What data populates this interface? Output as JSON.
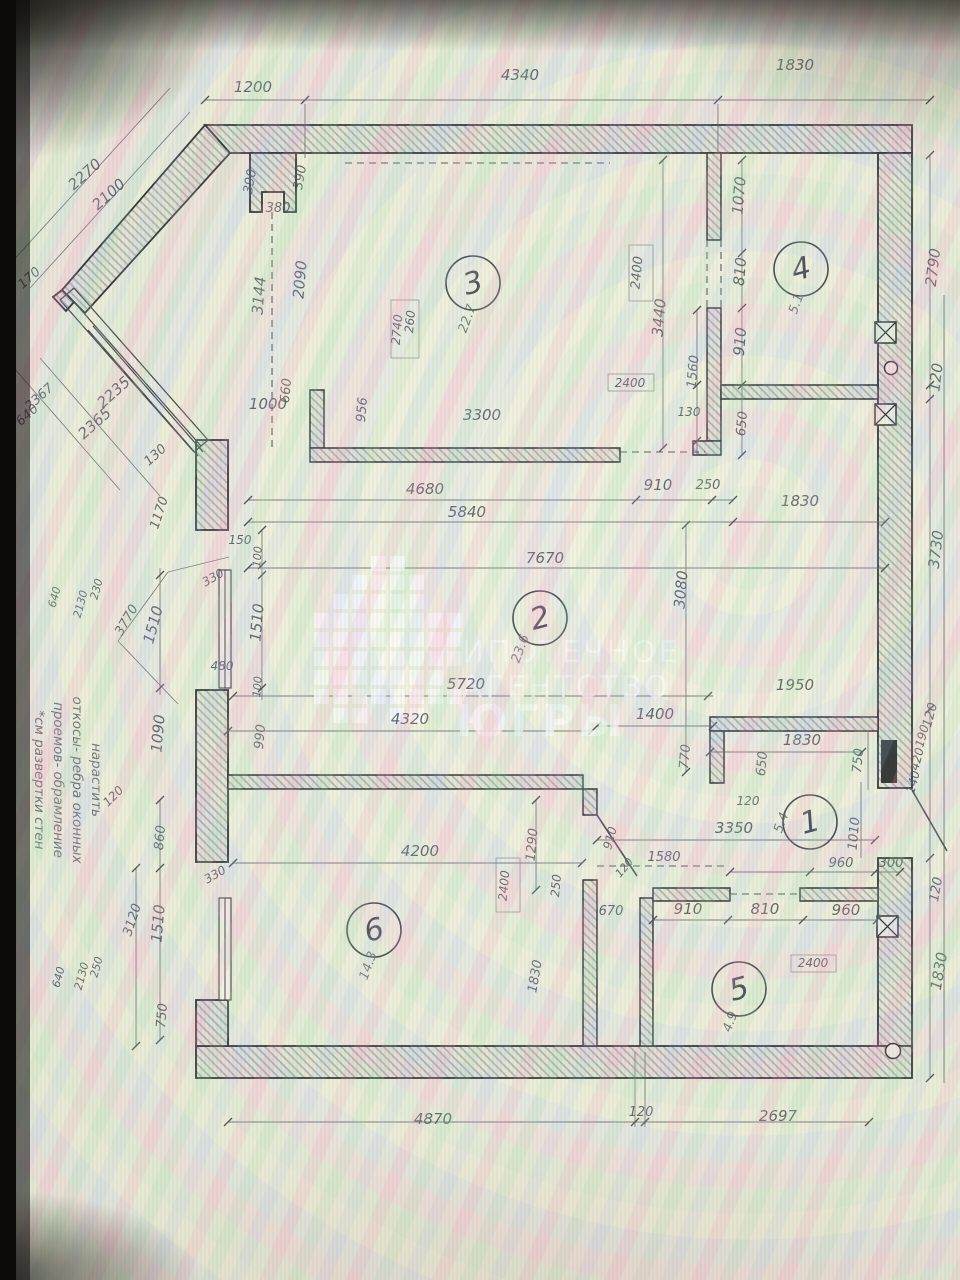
{
  "photo": {
    "description": "photo of a monitor displaying a scanned apartment floor plan",
    "bezel_color": "#0c0b0a"
  },
  "watermark": {
    "color": "#ffffff",
    "lines": [
      {
        "t": "ИПОТЕЧНОЕ",
        "x": 462,
        "y": 662,
        "s": 30,
        "w": 500
      },
      {
        "t": "АГЕНТСТВО",
        "x": 462,
        "y": 697,
        "s": 30,
        "w": 500
      },
      {
        "t": "ЮГРЫ",
        "x": 456,
        "y": 736,
        "s": 44,
        "w": 700
      }
    ],
    "pixels": {
      "origin_x": 314,
      "origin_y": 556,
      "cell": 15,
      "step": 19,
      "rows": [
        "...XX...",
        "..XXXX..",
        ".XXXXX..",
        "XXXXXXXX",
        "XXXXXXXX",
        "XXXXXXXX",
        "XXXXXXX.",
        "XXXXXXXX",
        ".XX.XX.."
      ]
    }
  },
  "annotation": {
    "x": 92,
    "y": 780,
    "line_step": 19,
    "lines": [
      "нарастить",
      "откосы- ребра оконных",
      "проемов- обрамление",
      "*см развертки стен"
    ]
  },
  "rooms": [
    {
      "n": "1",
      "a": "5.4",
      "cx": 810,
      "cy": 822,
      "ax": 785,
      "ay": 824
    },
    {
      "n": "2",
      "a": "23.6",
      "cx": 540,
      "cy": 618,
      "ax": 524,
      "ay": 650
    },
    {
      "n": "3",
      "a": "22.7",
      "cx": 473,
      "cy": 283,
      "ax": 471,
      "ay": 320
    },
    {
      "n": "4",
      "a": "5.1",
      "cx": 801,
      "cy": 269,
      "ax": 800,
      "ay": 305
    },
    {
      "n": "5",
      "a": "4.9",
      "cx": 739,
      "cy": 989,
      "ax": 734,
      "ay": 1023
    },
    {
      "n": "6",
      "a": "14.3",
      "cx": 374,
      "cy": 930,
      "ax": 372,
      "ay": 967
    }
  ],
  "labels": [
    {
      "t": "1200",
      "x": 253,
      "y": 92
    },
    {
      "t": "4340",
      "x": 520,
      "y": 80
    },
    {
      "t": "1830",
      "x": 795,
      "y": 70
    },
    {
      "t": "2790",
      "x": 938,
      "y": 268,
      "r": -83
    },
    {
      "t": "120",
      "x": 941,
      "y": 378,
      "r": -83
    },
    {
      "t": "3730",
      "x": 941,
      "y": 550,
      "r": -83
    },
    {
      "t": "120",
      "x": 934,
      "y": 716,
      "r": -75,
      "s": 13
    },
    {
      "t": "190",
      "x": 926,
      "y": 737,
      "r": -75,
      "s": 12
    },
    {
      "t": "420",
      "x": 921,
      "y": 760,
      "r": -75,
      "s": 12
    },
    {
      "t": "140",
      "x": 917,
      "y": 783,
      "r": -75,
      "s": 12
    },
    {
      "t": "120",
      "x": 940,
      "y": 890,
      "r": -80,
      "s": 13
    },
    {
      "t": "1830",
      "x": 944,
      "y": 972,
      "r": -80
    },
    {
      "t": "2270",
      "x": 88,
      "y": 178,
      "r": -42
    },
    {
      "t": "2100",
      "x": 112,
      "y": 198,
      "r": -42
    },
    {
      "t": "170",
      "x": 32,
      "y": 281,
      "r": -42,
      "s": 13
    },
    {
      "t": "2367",
      "x": 42,
      "y": 400,
      "r": -42,
      "s": 13
    },
    {
      "t": "640",
      "x": 30,
      "y": 418,
      "r": -42,
      "s": 13
    },
    {
      "t": "2365",
      "x": 98,
      "y": 427,
      "r": -42
    },
    {
      "t": "2235",
      "x": 117,
      "y": 396,
      "r": -42
    },
    {
      "t": "130",
      "x": 158,
      "y": 458,
      "r": -42,
      "s": 13
    },
    {
      "t": "1170",
      "x": 163,
      "y": 514,
      "r": -72,
      "s": 13
    },
    {
      "t": "390",
      "x": 254,
      "y": 182,
      "r": -80,
      "s": 13
    },
    {
      "t": "390",
      "x": 304,
      "y": 178,
      "r": -80,
      "s": 13
    },
    {
      "t": "380",
      "x": 278,
      "y": 212,
      "s": 13
    },
    {
      "t": "2090",
      "x": 305,
      "y": 280,
      "r": -85
    },
    {
      "t": "3144",
      "x": 264,
      "y": 296,
      "r": -85
    },
    {
      "t": "660",
      "x": 290,
      "y": 391,
      "r": -85,
      "s": 13
    },
    {
      "t": "1000",
      "x": 268,
      "y": 409
    },
    {
      "t": "956",
      "x": 366,
      "y": 410,
      "r": -85,
      "s": 13
    },
    {
      "t": "3300",
      "x": 482,
      "y": 420
    },
    {
      "t": "260",
      "x": 414,
      "y": 322,
      "r": -85,
      "s": 12
    },
    {
      "t": "2740",
      "x": 401,
      "y": 330,
      "r": -85,
      "s": 12
    },
    {
      "t": "2400",
      "x": 641,
      "y": 273,
      "r": -85,
      "s": 13
    },
    {
      "t": "3440",
      "x": 664,
      "y": 318,
      "r": -85
    },
    {
      "t": "1560",
      "x": 697,
      "y": 372,
      "r": -85,
      "s": 13
    },
    {
      "t": "130",
      "x": 689,
      "y": 416,
      "s": 12
    },
    {
      "t": "1070",
      "x": 744,
      "y": 196,
      "r": -85
    },
    {
      "t": "810",
      "x": 745,
      "y": 272,
      "r": -85
    },
    {
      "t": "910",
      "x": 745,
      "y": 342,
      "r": -85
    },
    {
      "t": "650",
      "x": 746,
      "y": 424,
      "r": -85,
      "s": 13
    },
    {
      "t": "2400",
      "x": 630,
      "y": 387,
      "s": 12
    },
    {
      "t": "910",
      "x": 658,
      "y": 490
    },
    {
      "t": "250",
      "x": 708,
      "y": 489,
      "s": 13
    },
    {
      "t": "1830",
      "x": 800,
      "y": 506
    },
    {
      "t": "4680",
      "x": 425,
      "y": 494
    },
    {
      "t": "5840",
      "x": 467,
      "y": 517
    },
    {
      "t": "7670",
      "x": 545,
      "y": 563
    },
    {
      "t": "3080",
      "x": 686,
      "y": 590,
      "r": -85
    },
    {
      "t": "1950",
      "x": 795,
      "y": 690
    },
    {
      "t": "1400",
      "x": 655,
      "y": 719
    },
    {
      "t": "5720",
      "x": 466,
      "y": 689
    },
    {
      "t": "4320",
      "x": 410,
      "y": 724
    },
    {
      "t": "770",
      "x": 689,
      "y": 757,
      "r": -85,
      "s": 13
    },
    {
      "t": "1830",
      "x": 802,
      "y": 745
    },
    {
      "t": "650",
      "x": 766,
      "y": 764,
      "r": -85,
      "s": 13
    },
    {
      "t": "750",
      "x": 862,
      "y": 761,
      "r": -85,
      "s": 13
    },
    {
      "t": "120",
      "x": 748,
      "y": 805,
      "s": 12
    },
    {
      "t": "3350",
      "x": 734,
      "y": 833
    },
    {
      "t": "1010",
      "x": 858,
      "y": 834,
      "r": -85,
      "s": 13
    },
    {
      "t": "1580",
      "x": 664,
      "y": 861,
      "s": 13
    },
    {
      "t": "960",
      "x": 841,
      "y": 867,
      "s": 13
    },
    {
      "t": "300",
      "x": 891,
      "y": 867,
      "s": 13
    },
    {
      "t": "1290",
      "x": 536,
      "y": 845,
      "r": -85,
      "s": 13
    },
    {
      "t": "910",
      "x": 614,
      "y": 839,
      "r": -75,
      "s": 12
    },
    {
      "t": "250",
      "x": 560,
      "y": 886,
      "r": -85,
      "s": 12
    },
    {
      "t": "120",
      "x": 627,
      "y": 870,
      "r": -50,
      "s": 11
    },
    {
      "t": "670",
      "x": 611,
      "y": 915,
      "s": 13
    },
    {
      "t": "910",
      "x": 688,
      "y": 914
    },
    {
      "t": "810",
      "x": 765,
      "y": 914
    },
    {
      "t": "960",
      "x": 846,
      "y": 915
    },
    {
      "t": "2400",
      "x": 813,
      "y": 967,
      "s": 12
    },
    {
      "t": "2400",
      "x": 508,
      "y": 886,
      "r": -85,
      "s": 12
    },
    {
      "t": "1830",
      "x": 539,
      "y": 977,
      "r": -80,
      "s": 13
    },
    {
      "t": "150",
      "x": 240,
      "y": 544,
      "s": 12
    },
    {
      "t": "100",
      "x": 261,
      "y": 557,
      "r": -85,
      "s": 11
    },
    {
      "t": "330",
      "x": 215,
      "y": 581,
      "r": -30,
      "s": 12
    },
    {
      "t": "1510",
      "x": 262,
      "y": 623,
      "r": -85
    },
    {
      "t": "1510",
      "x": 158,
      "y": 626,
      "r": -75
    },
    {
      "t": "3770",
      "x": 130,
      "y": 622,
      "r": -60,
      "s": 13
    },
    {
      "t": "230",
      "x": 100,
      "y": 590,
      "r": -75,
      "s": 11
    },
    {
      "t": "2130",
      "x": 84,
      "y": 605,
      "r": -75,
      "s": 11
    },
    {
      "t": "640",
      "x": 58,
      "y": 598,
      "r": -75,
      "s": 11
    },
    {
      "t": "480",
      "x": 222,
      "y": 670,
      "s": 12
    },
    {
      "t": "100",
      "x": 261,
      "y": 687,
      "r": -85,
      "s": 11
    },
    {
      "t": "1090",
      "x": 163,
      "y": 734,
      "r": -85
    },
    {
      "t": "990",
      "x": 264,
      "y": 737,
      "r": -85,
      "s": 13
    },
    {
      "t": "120",
      "x": 116,
      "y": 799,
      "r": -45,
      "s": 12
    },
    {
      "t": "860",
      "x": 164,
      "y": 838,
      "r": -85,
      "s": 13
    },
    {
      "t": "330",
      "x": 217,
      "y": 878,
      "r": -30,
      "s": 12
    },
    {
      "t": "1510",
      "x": 163,
      "y": 924,
      "r": -85
    },
    {
      "t": "3120",
      "x": 136,
      "y": 921,
      "r": -72,
      "s": 13
    },
    {
      "t": "750",
      "x": 166,
      "y": 1016,
      "r": -85,
      "s": 13
    },
    {
      "t": "250",
      "x": 100,
      "y": 968,
      "r": -75,
      "s": 11
    },
    {
      "t": "2130",
      "x": 85,
      "y": 977,
      "r": -75,
      "s": 11
    },
    {
      "t": "640",
      "x": 62,
      "y": 978,
      "r": -75,
      "s": 11
    },
    {
      "t": "4200",
      "x": 420,
      "y": 856
    },
    {
      "t": "4870",
      "x": 433,
      "y": 1124
    },
    {
      "t": "120",
      "x": 641,
      "y": 1116,
      "s": 13
    },
    {
      "t": "2697",
      "x": 778,
      "y": 1121
    }
  ]
}
